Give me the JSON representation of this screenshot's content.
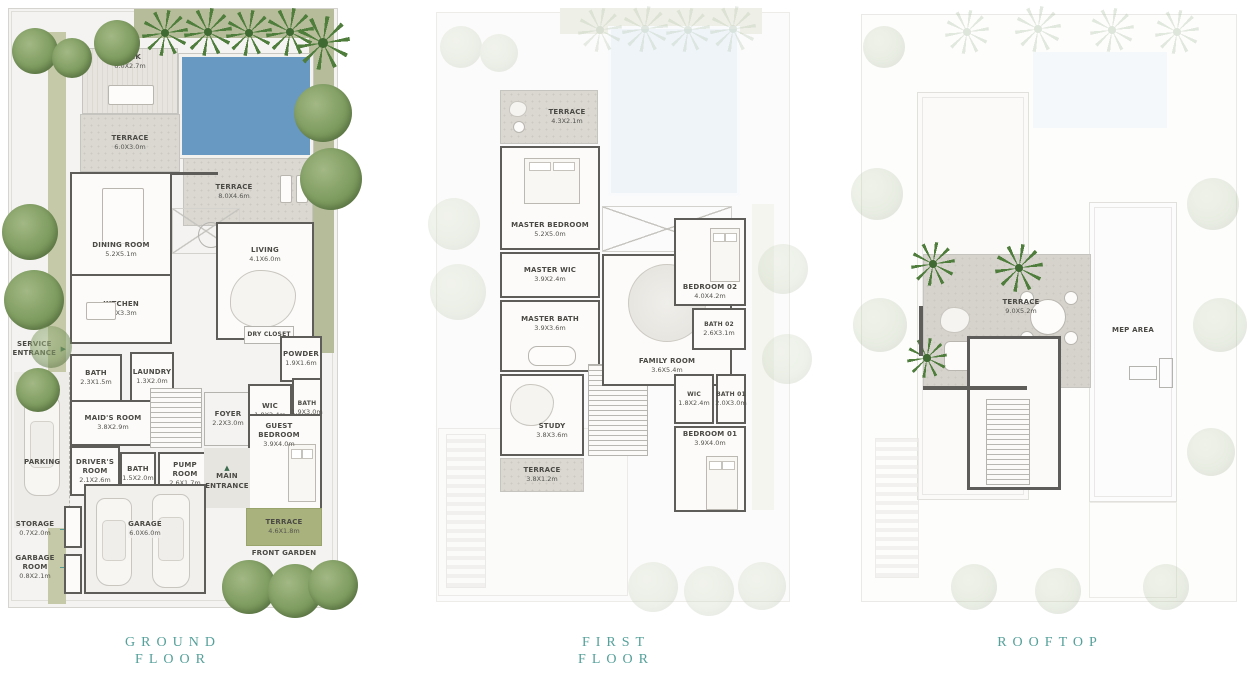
{
  "icons": {
    "triangle_up": "▲",
    "triangle_right": "▶"
  },
  "titles": {
    "ground": {
      "line1": "GROUND",
      "line2": "FLOOR"
    },
    "first": {
      "line1": "FIRST",
      "line2": "FLOOR"
    },
    "rooftop": {
      "line1": "ROOFTOP"
    }
  },
  "ground": {
    "deck": {
      "label": "DECK",
      "dims": "6.0X2.7m"
    },
    "terrace_top": {
      "label": "TERRACE",
      "dims": "6.0X3.0m"
    },
    "terrace_pool": {
      "label": "TERRACE",
      "dims": "8.0X4.6m"
    },
    "dining": {
      "label": "DINING ROOM",
      "dims": "5.2X5.1m"
    },
    "living": {
      "label": "LIVING",
      "dims": "4.1X6.0m"
    },
    "kitchen": {
      "label": "KITCHEN",
      "dims": "5.2X3.3m"
    },
    "service_entrance": {
      "label": "SERVICE ENTRANCE"
    },
    "bath_a": {
      "label": "BATH",
      "dims": "2.3X1.5m"
    },
    "laundry": {
      "label": "LAUNDRY",
      "dims": "1.3X2.0m"
    },
    "maids_room": {
      "label": "MAID'S ROOM",
      "dims": "3.8X2.9m"
    },
    "drivers_room": {
      "label": "DRIVER'S ROOM",
      "dims": "2.1X2.6m"
    },
    "bath_b": {
      "label": "BATH",
      "dims": "1.5X2.0m"
    },
    "pump_room": {
      "label": "PUMP ROOM",
      "dims": "2.6X1.7m"
    },
    "foyer": {
      "label": "FOYER",
      "dims": "2.2X3.0m"
    },
    "dry_closet": {
      "label": "DRY CLOSET"
    },
    "powder": {
      "label": "POWDER",
      "dims": "1.9X1.6m"
    },
    "wic": {
      "label": "WIC",
      "dims": "1.8X2.4m"
    },
    "bath_c": {
      "label": "BATH",
      "dims": "1.9X3.0m"
    },
    "guest_bedroom": {
      "label": "GUEST BEDROOM",
      "dims": "3.9X4.0m"
    },
    "main_entrance": {
      "label": "MAIN ENTRANCE"
    },
    "parking": {
      "label": "PARKING"
    },
    "storage": {
      "label": "STORAGE",
      "dims": "0.7X2.0m"
    },
    "garbage_room": {
      "label": "GARBAGE ROOM",
      "dims": "0.8X2.1m"
    },
    "garage": {
      "label": "GARAGE",
      "dims": "6.0X6.0m"
    },
    "terrace_front": {
      "label": "TERRACE",
      "dims": "4.6X1.8m"
    },
    "front_garden": {
      "label": "FRONT GARDEN"
    }
  },
  "first": {
    "terrace": {
      "label": "TERRACE",
      "dims": "4.3X2.1m"
    },
    "master_bedroom": {
      "label": "MASTER BEDROOM",
      "dims": "5.2X5.0m"
    },
    "master_wic": {
      "label": "MASTER WIC",
      "dims": "3.9X2.4m"
    },
    "master_bath": {
      "label": "MASTER BATH",
      "dims": "3.9X3.6m"
    },
    "family_room": {
      "label": "FAMILY ROOM",
      "dims": "3.6X5.4m"
    },
    "bedroom_02": {
      "label": "BEDROOM 02",
      "dims": "4.0X4.2m"
    },
    "bath_02": {
      "label": "BATH 02",
      "dims": "2.6X3.1m"
    },
    "study": {
      "label": "STUDY",
      "dims": "3.8X3.6m"
    },
    "terrace_small": {
      "label": "TERRACE",
      "dims": "3.8X1.2m"
    },
    "wic": {
      "label": "WIC",
      "dims": "1.8X2.4m"
    },
    "bath_01": {
      "label": "BATH 01",
      "dims": "2.0X3.0m"
    },
    "bedroom_01": {
      "label": "BEDROOM 01",
      "dims": "3.9X4.0m"
    }
  },
  "rooftop": {
    "terrace": {
      "label": "TERRACE",
      "dims": "9.0X5.2m"
    },
    "mep_area": {
      "label": "MEP AREA"
    }
  }
}
